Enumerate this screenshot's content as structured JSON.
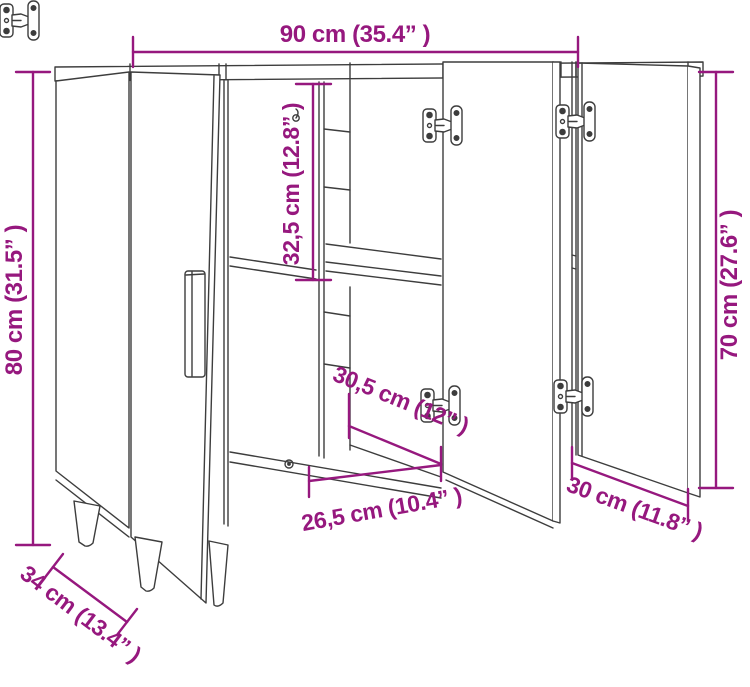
{
  "diagram": {
    "type": "furniture-dimension-drawing",
    "subject": "sideboard-cabinet-with-three-open-doors",
    "colors": {
      "dimension_accent": "#96187e",
      "drawing_line": "#3d3d3d",
      "background": "#ffffff"
    },
    "dimensions": {
      "width_top": "90 cm (35.4” )",
      "height_left": "80 cm (31.5” )",
      "height_right": "70 cm (27.6” )",
      "interior_height": "32,5 cm (12.8” )",
      "interior_depth": "30,5 cm (12” )",
      "interior_width": "26,5 cm (10.4” )",
      "door_width": "30 cm (11.8” )",
      "base_depth": "34 cm (13.4” )"
    }
  }
}
